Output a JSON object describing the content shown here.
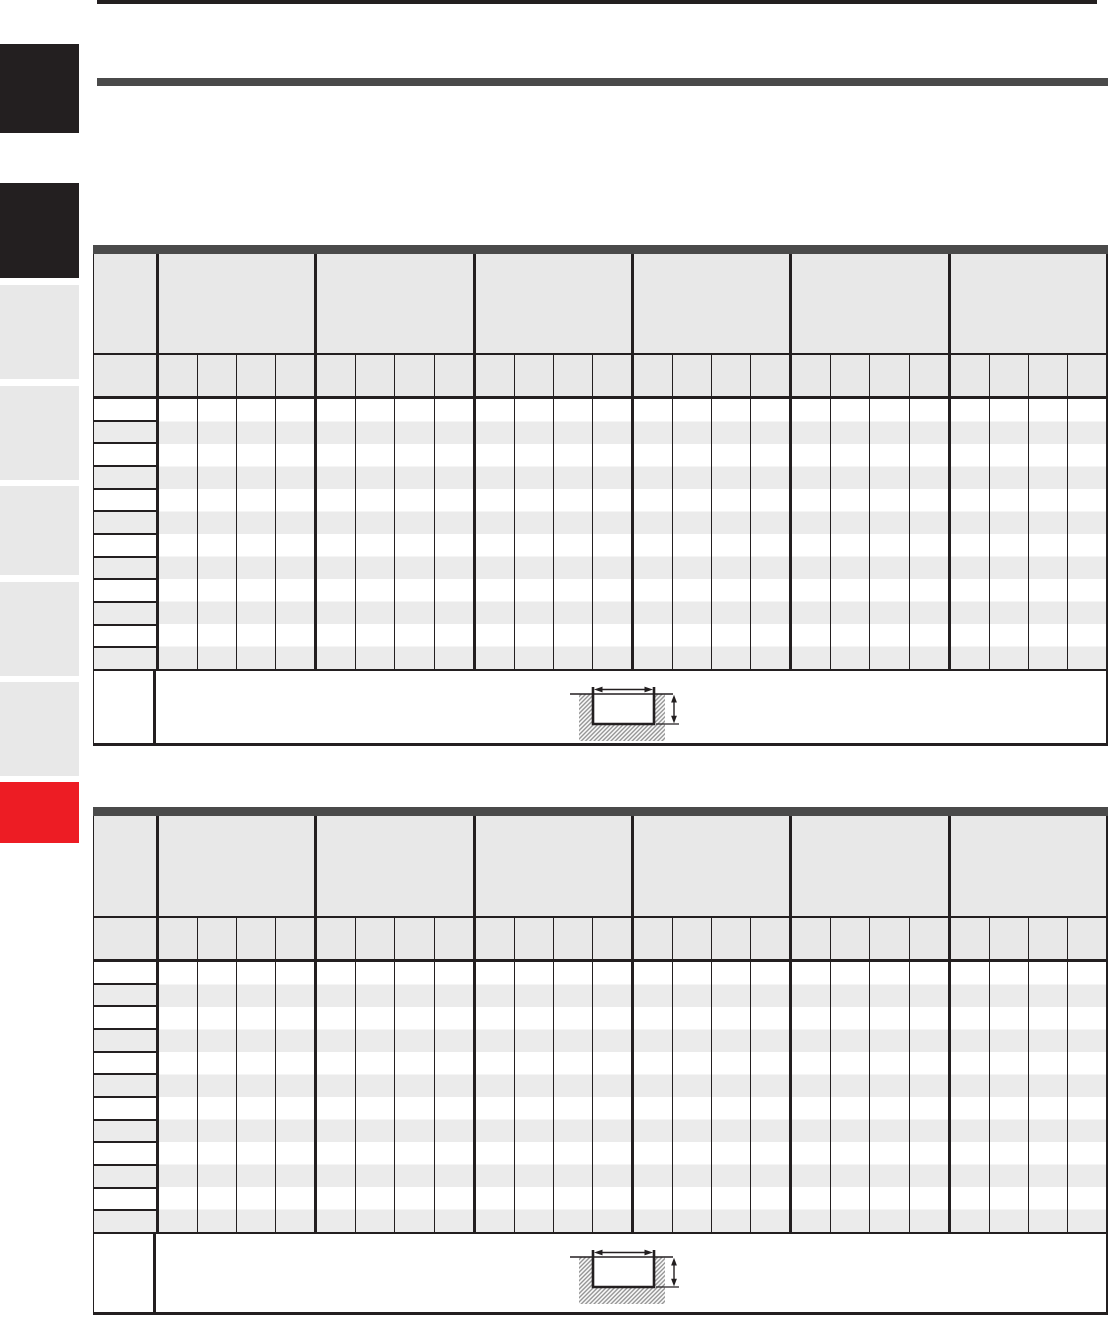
{
  "page": {
    "kind": "catalog-dimension-table-page",
    "title_text": "",
    "all_text_rendered": false,
    "background": "#ffffff"
  },
  "colors": {
    "ink": "#231f20",
    "bar_dark": "#4a4a4a",
    "header_fill": "#e8e8e8",
    "row_alt_fill": "#ebebeb",
    "sidebar_black": "#231f20",
    "sidebar_gray": "#e8e8e8",
    "sidebar_red": "#ed1c24",
    "hatch_gray": "#8f8f8f"
  },
  "sidebar": {
    "tabs": [
      {
        "id": "index-tab-1",
        "color": "#231f20"
      },
      {
        "id": "index-tab-2",
        "color": "#231f20"
      },
      {
        "id": "index-tab-3",
        "color": "#e8e8e8"
      },
      {
        "id": "index-tab-4",
        "color": "#e8e8e8"
      },
      {
        "id": "index-tab-5",
        "color": "#e8e8e8"
      },
      {
        "id": "index-tab-6",
        "color": "#e8e8e8"
      },
      {
        "id": "index-tab-7",
        "color": "#e8e8e8"
      },
      {
        "id": "index-tab-8",
        "color": "#ed1c24"
      }
    ]
  },
  "tables": [
    {
      "name": "upper-table",
      "column_groups": 6,
      "subcolumns_per_group": 4,
      "body_rows": 12,
      "row_shading": "alternating white / light gray",
      "all_cells_empty": true,
      "footer_diagram": {
        "type": "groove-cross-section",
        "dimensions_indicated": [
          "groove-width",
          "groove-depth"
        ]
      }
    },
    {
      "name": "lower-table",
      "column_groups": 6,
      "subcolumns_per_group": 4,
      "body_rows": 12,
      "row_shading": "alternating white / light gray",
      "all_cells_empty": true,
      "footer_diagram": {
        "type": "groove-cross-section",
        "dimensions_indicated": [
          "groove-width",
          "groove-depth"
        ]
      }
    }
  ]
}
